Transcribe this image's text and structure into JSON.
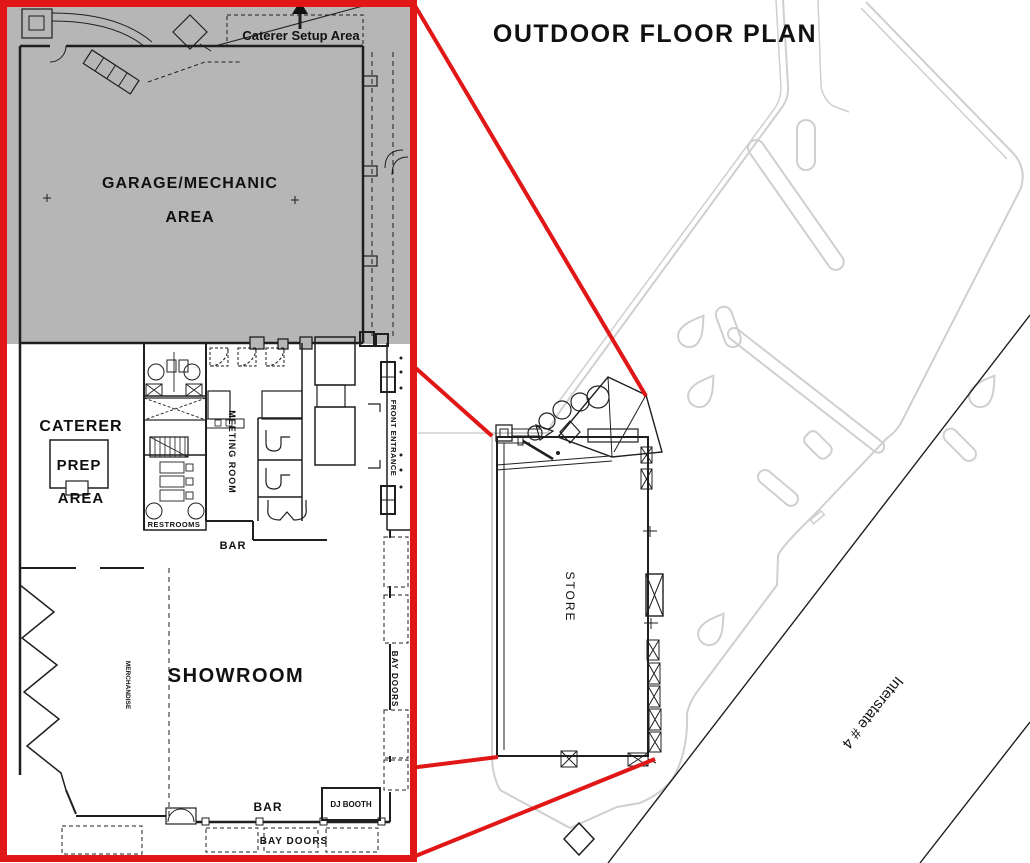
{
  "page": {
    "title": "OUTDOOR FLOOR PLAN"
  },
  "colors": {
    "accent_red": "#e11717",
    "garage_gray": "#b6b6b6",
    "site_line_gray": "#cfcfcf",
    "plan_line_dark": "#1f1f1f"
  },
  "icons": {
    "north_arrow": "up-arrow"
  },
  "inset_plan": {
    "caterer_setup_label": "Caterer Setup Area",
    "garage_label_line1": "GARAGE/MECHANIC",
    "garage_label_line2": "AREA",
    "caterer_prep": {
      "line1": "CATERER",
      "line2": "PREP",
      "line3": "AREA"
    },
    "restrooms_label": "RESTROOMS",
    "meeting_room_label": "MEETING ROOM",
    "bar_upper_label": "BAR",
    "front_entrance_label": "FRONT ENTRANCE",
    "showroom_label": "SHOWROOM",
    "merchandise_label": "MERCHANDISE",
    "bar_lower_label": "BAR",
    "dj_booth_label": "DJ BOOTH",
    "bay_doors_bottom_label": "BAY DOORS",
    "bay_doors_right_label": "BAY DOORS"
  },
  "site_plan": {
    "store_label": "STORE",
    "interstate_label": "Interstate # 4"
  }
}
